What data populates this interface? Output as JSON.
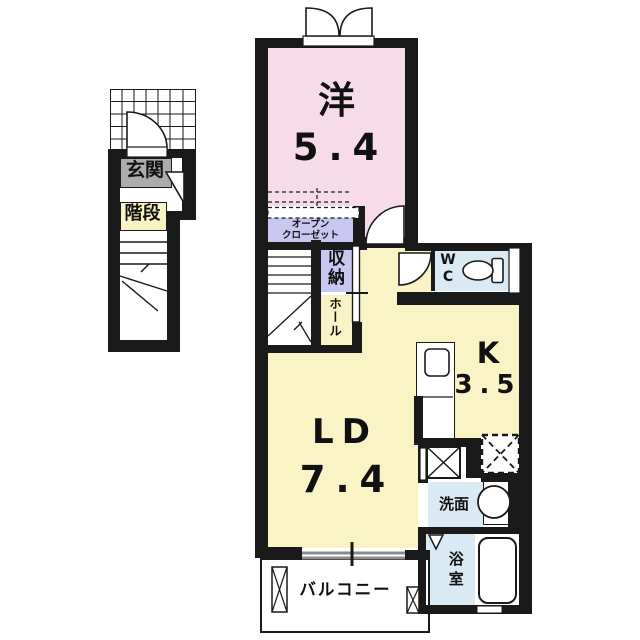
{
  "floorplan": {
    "entrance": {
      "label": "玄関"
    },
    "staircase": {
      "label": "階段"
    },
    "rooms": {
      "western": {
        "name": "洋",
        "size": "5.4"
      },
      "open_closet": {
        "line1": "オープン",
        "line2": "クローゼット"
      },
      "storage": {
        "label": "収納"
      },
      "hall": {
        "label": "ホール"
      },
      "wc": {
        "line1": "W",
        "line2": "C"
      },
      "kitchen": {
        "name": "K",
        "size": "3.5"
      },
      "living_dining": {
        "name": "LD",
        "size": "7.4"
      },
      "washroom": {
        "label": "洗面"
      },
      "bathroom": {
        "label": "浴室"
      },
      "balcony": {
        "label": "バルコニー"
      }
    },
    "colors": {
      "wall": "#1a1a1a",
      "western_room_pink": "#f8dbe9",
      "main_floor_yellow": "#faf3c6",
      "closet_lavender": "#c7c7ef",
      "wet_area_blue": "#d9eaf5",
      "entrance_gray": "#acacac",
      "window_gray": "#8c8c8c"
    }
  }
}
